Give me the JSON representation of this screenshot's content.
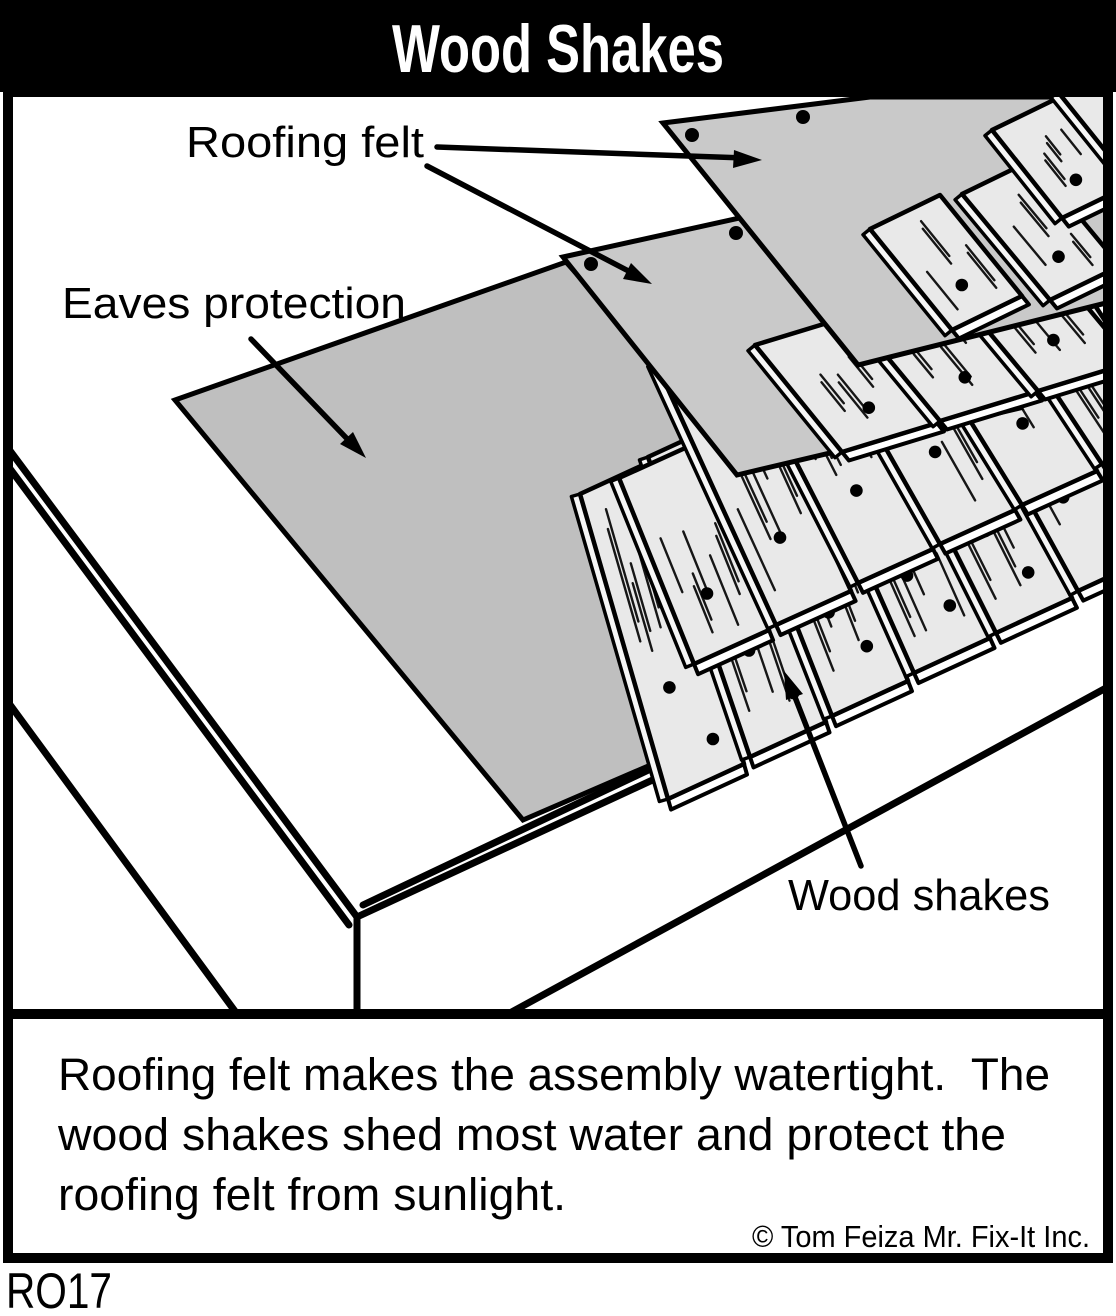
{
  "title": "Wood Shakes",
  "labels": {
    "roofing_felt": "Roofing felt",
    "eaves_protection": "Eaves protection",
    "wood_shakes": "Wood shakes"
  },
  "caption": {
    "line1": "Roofing felt makes the assembly watertight.  The",
    "line2": "wood shakes shed most water and protect the",
    "line3": "roofing felt from sunlight.",
    "credit": "© Tom Feiza Mr. Fix-It Inc."
  },
  "figure_code": "RO17",
  "colors": {
    "felt": "#c9c9c9",
    "eaves_felt": "#bfbfbf",
    "shake_face": "#e9e9e9",
    "shake_bevel": "#f6f6f6",
    "title_bg": "#000000",
    "title_text": "#ffffff"
  }
}
